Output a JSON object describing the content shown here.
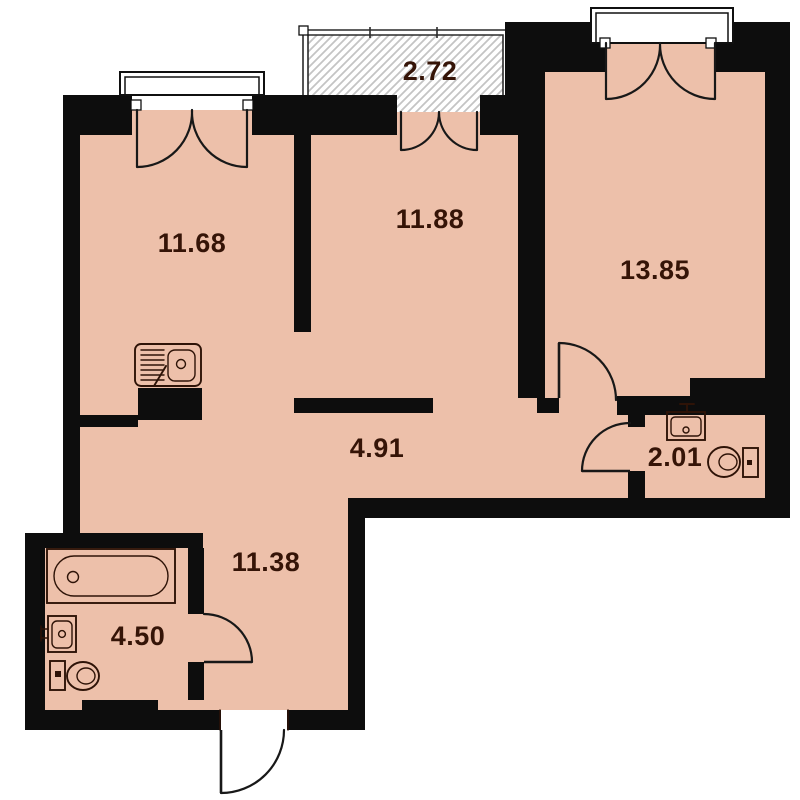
{
  "title": "apartment-floor-plan",
  "units": "m2",
  "rooms": {
    "balcony": {
      "area": "2.72"
    },
    "kitchen_living": {
      "area": "11.68"
    },
    "bedroom": {
      "area": "11.88"
    },
    "living": {
      "area": "13.85"
    },
    "corridor": {
      "area": "4.91"
    },
    "wc": {
      "area": "2.01"
    },
    "hall": {
      "area": "11.38"
    },
    "bathroom": {
      "area": "4.50"
    }
  },
  "fixtures": {
    "kitchen_sink": "kitchen-sink-icon",
    "bathtub": "bathtub-icon",
    "bathroom_washbasin": "washbasin-icon",
    "bathroom_toilet": "toilet-icon",
    "wc_washbasin": "washbasin-icon",
    "wc_toilet": "toilet-icon"
  },
  "colors": {
    "floor": "#edc0aa",
    "wall": "#0d0d0d",
    "line": "#2e1307",
    "label": "#351407",
    "hatch": "#c4c4c4",
    "background": "#ffffff"
  }
}
